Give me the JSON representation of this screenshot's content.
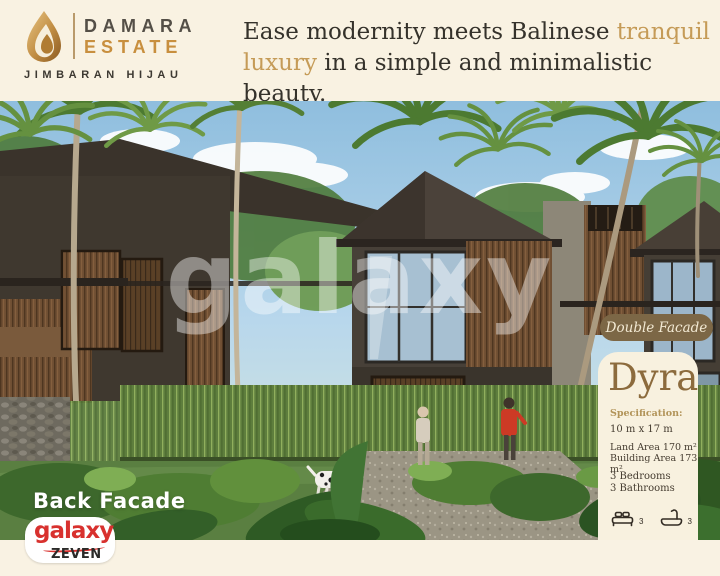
{
  "brand": {
    "name_top": "DAMARA",
    "name_bottom": "ESTATE",
    "location": "JIMBARAN HIJAU"
  },
  "tagline": {
    "line1_text": "Ease modernity meets Balinese",
    "line1_highlight": "tranquil",
    "line2_highlight": "luxury",
    "line2_text": "in a simple and minimalistic beauty."
  },
  "photo": {
    "watermark": "galaxy",
    "facade_label": "Back Facade"
  },
  "unit": {
    "badge": "Double Facade",
    "name": "Dyra",
    "spec_heading": "Specification:",
    "dimensions": "10 m x 17 m",
    "land_area": "Land Area 170 m²",
    "building_area": "Building Area 173 m²",
    "bedrooms": "3 Bedrooms",
    "bathrooms": "3 Bathrooms",
    "bed_count": "3",
    "bath_count": "3"
  },
  "publisher": {
    "name": "galaxy",
    "sub": "ZEVEN"
  },
  "colors": {
    "cream": "#f9f2e2",
    "panel_cream": "#f8f1df",
    "tagline_gold": "#c59b57",
    "estate_gold": "#c88f3e",
    "badge_brown": "#7c6746",
    "unit_title_brown": "#8c6b3d",
    "text_dark": "#35322b",
    "publisher_red": "#d8312e"
  }
}
